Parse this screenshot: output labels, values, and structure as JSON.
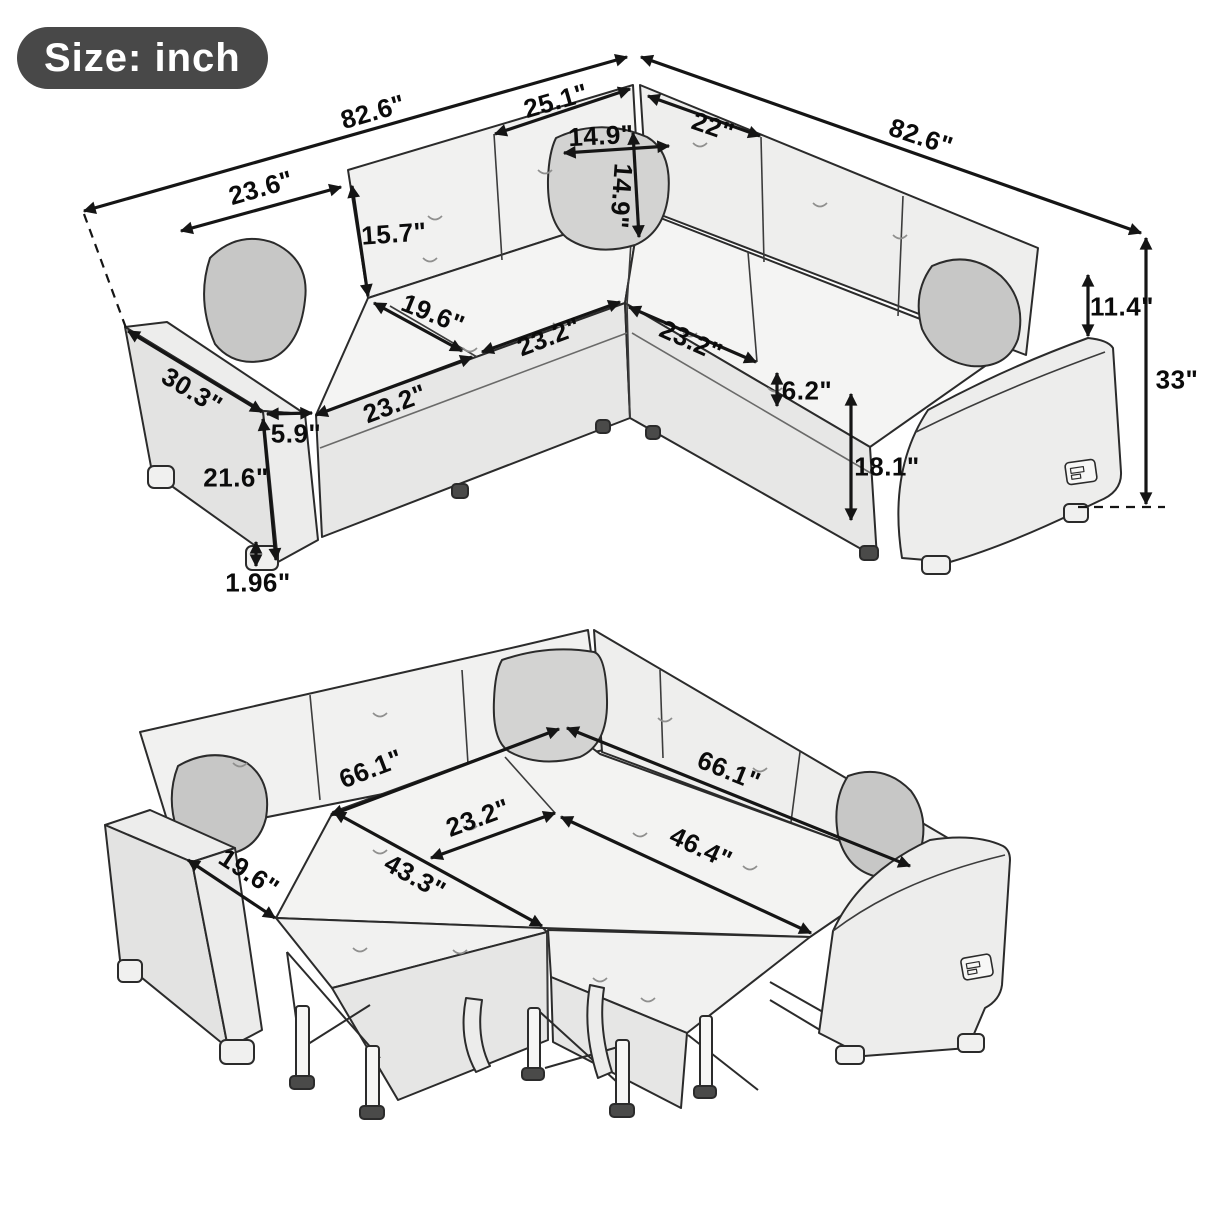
{
  "badge": {
    "label": "Size: inch"
  },
  "unit": "inch",
  "sofa_view": {
    "name": "L-shaped sectional sofa - upright configuration",
    "dims": {
      "overall_left": "82.6\"",
      "back_corner_left": "25.1\"",
      "overall_right": "82.6\"",
      "back_corner_right": "22\"",
      "pillow_width": "14.9\"",
      "pillow_height": "14.9\"",
      "backrest_width": "23.6\"",
      "backrest_height": "15.7\"",
      "seat_depth": "19.6\"",
      "seat_width_left": "23.2\"",
      "seat_width_middle": "23.2\"",
      "seat_width_right": "23.2\"",
      "armrest_length": "30.3\"",
      "armrest_width": "5.9\"",
      "arm_height": "21.6\"",
      "leg_height": "1.96\"",
      "cushion_thickness": "6.2\"",
      "seat_height": "18.1\"",
      "back_above_arm": "11.4\"",
      "overall_height": "33\""
    }
  },
  "bed_view": {
    "name": "Sectional converted to sleeper bed",
    "dims": {
      "bed_length_left": "66.1\"",
      "bed_length_right": "66.1\"",
      "corner_seat_width": "23.2\"",
      "bed_depth_right": "46.4\"",
      "bed_depth_left": "43.3\"",
      "seat_depth": "19.6\""
    }
  },
  "colors": {
    "line": "#151515",
    "badge_bg": "#484848",
    "badge_text": "#ffffff"
  }
}
